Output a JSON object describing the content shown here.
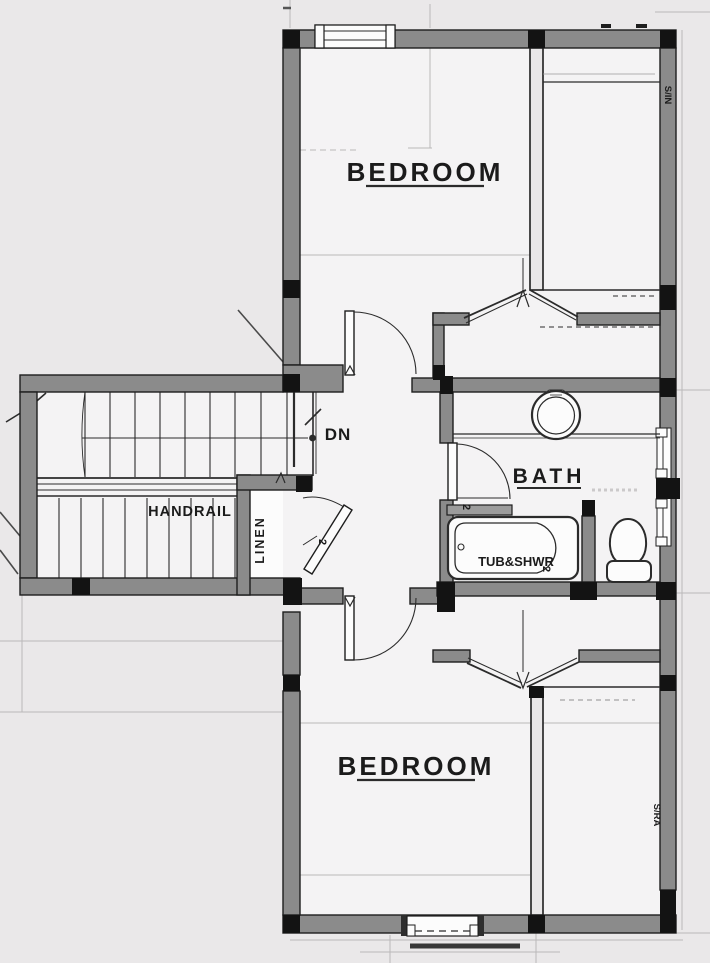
{
  "labels": {
    "bedroom_top": "BEDROOM",
    "bedroom_bottom": "BEDROOM",
    "bath": "BATH",
    "handrail": "HANDRAIL",
    "linen": "LINEN",
    "down": "DN",
    "tub": "TUB&SHWR",
    "door_size_linen": "2",
    "door_size_bath": "2",
    "door_size_tub": "2",
    "wall_note_top": "S/IN",
    "wall_note_bottom": "S/RA"
  },
  "colors": {
    "background": "#eae8e9",
    "room": "#f4f3f4",
    "wall_fill": "#8b8b8b",
    "wall_edge": "#1e1e1e",
    "black_block": "#131313",
    "line": "#2b2b2b",
    "ghost": "#bab8b9",
    "white": "#fcfcfc"
  }
}
